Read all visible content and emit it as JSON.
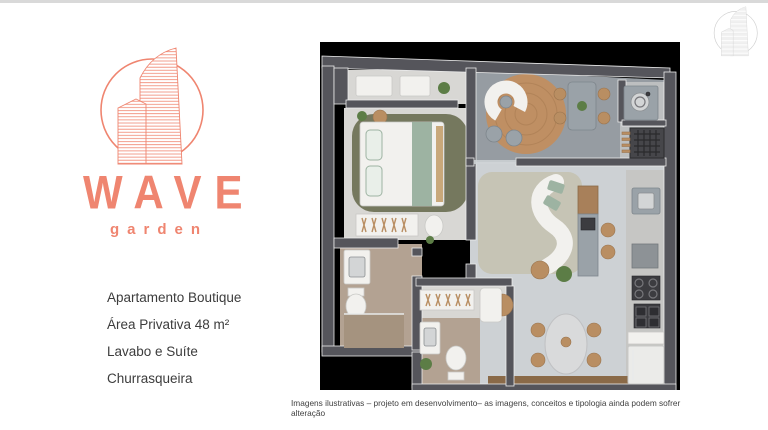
{
  "brand": {
    "name": "WAVE",
    "subtitle": "garden"
  },
  "details": {
    "lines": [
      "Apartamento Boutique",
      "Área Privativa 48 m²",
      "Lavabo e Suíte",
      "Churrasqueira"
    ]
  },
  "disclaimer": "Imagens ilustrativas – projeto em desenvolvimento– as imagens, conceitos e tipologia ainda podem sofrer alteração",
  "colors": {
    "accent": "#EF8570",
    "watermark": "#C9C9C9",
    "text": "#3C3C3C",
    "caption": "#404040",
    "top_border": "#D9D9D9",
    "plan_bg": "#000000",
    "wall": "#55555B",
    "wall_line": "#EBEBEB",
    "floor_light": "#D8D7D4",
    "floor_gray": "#969CA2",
    "floor_living": "#CDD1D4",
    "floor_beige": "#B3A292",
    "floor_beige_dark": "#A5937F",
    "rug_green": "#75785E",
    "rug_beige": "#C6C4B5",
    "rug_rattan": "#BF8F63",
    "wood": "#B98E62",
    "wood_dark": "#8A6A48",
    "white_furniture": "#F2F1EE",
    "sage": "#9DB3A2",
    "gray_furniture": "#9AA2A8",
    "dark_appliance": "#3C3C40",
    "marble": "#D9DADB",
    "counter": "#C6C6C4",
    "plant": "#5C7D46"
  }
}
